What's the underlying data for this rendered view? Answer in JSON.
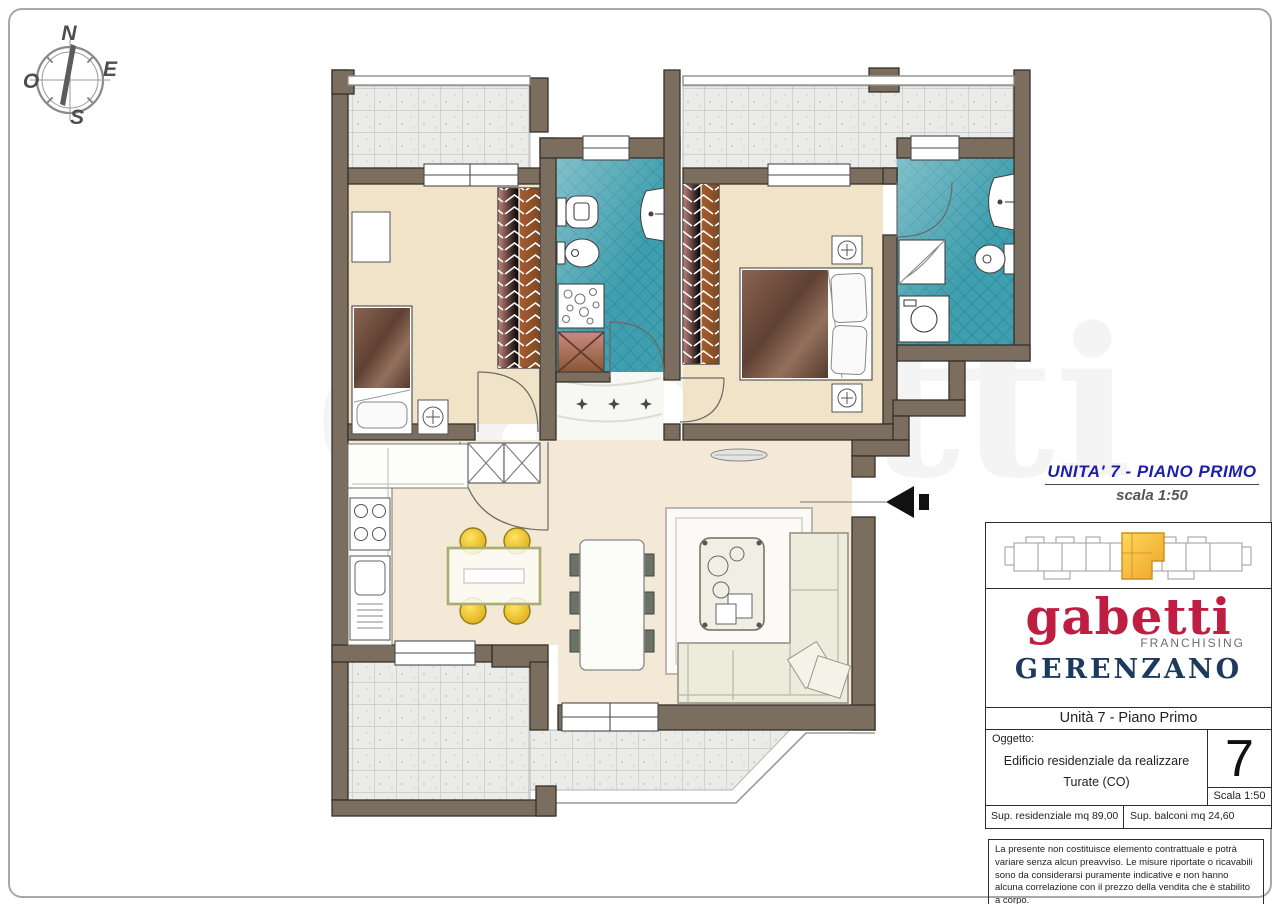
{
  "compass": {
    "north": "N",
    "east": "E",
    "south": "S",
    "west": "O"
  },
  "annotation": {
    "title": "UNITA' 7 - PIANO PRIMO",
    "scale": "scala 1:50"
  },
  "watermark": "gabetti",
  "title_block": {
    "logo_text": "gabetti",
    "logo_sub": "FRANCHISING",
    "agency": "GERENZANO",
    "unit_line": "Unità 7 - Piano Primo",
    "object_label": "Oggetto:",
    "object_line1": "Edificio residenziale da realizzare",
    "object_line2": "Turate (CO)",
    "unit_number": "7",
    "scale_label": "Scala 1:50",
    "sup_residenziale": "Sup. residenziale mq 89,00",
    "sup_balconi": "Sup. balconi mq 24,60",
    "disclaimer": "La presente non costituisce elemento contrattuale e potrà variare senza alcun preavviso. Le misure riportate o ricavabili sono da considerarsi puramente indicative e non hanno alcuna correlazione con il prezzo della vendita che è stabilito a corpo."
  },
  "colors": {
    "brand_red": "#be1e42",
    "navy": "#1c3a5e",
    "heading_blue": "#1d1daa",
    "wall": "#7b6e5f",
    "bath_teal": "#3f9fae",
    "floor_beige": "#f1e3c8",
    "terrace_gray": "#ebebe9",
    "unit_highlight": "#f7c32e"
  }
}
